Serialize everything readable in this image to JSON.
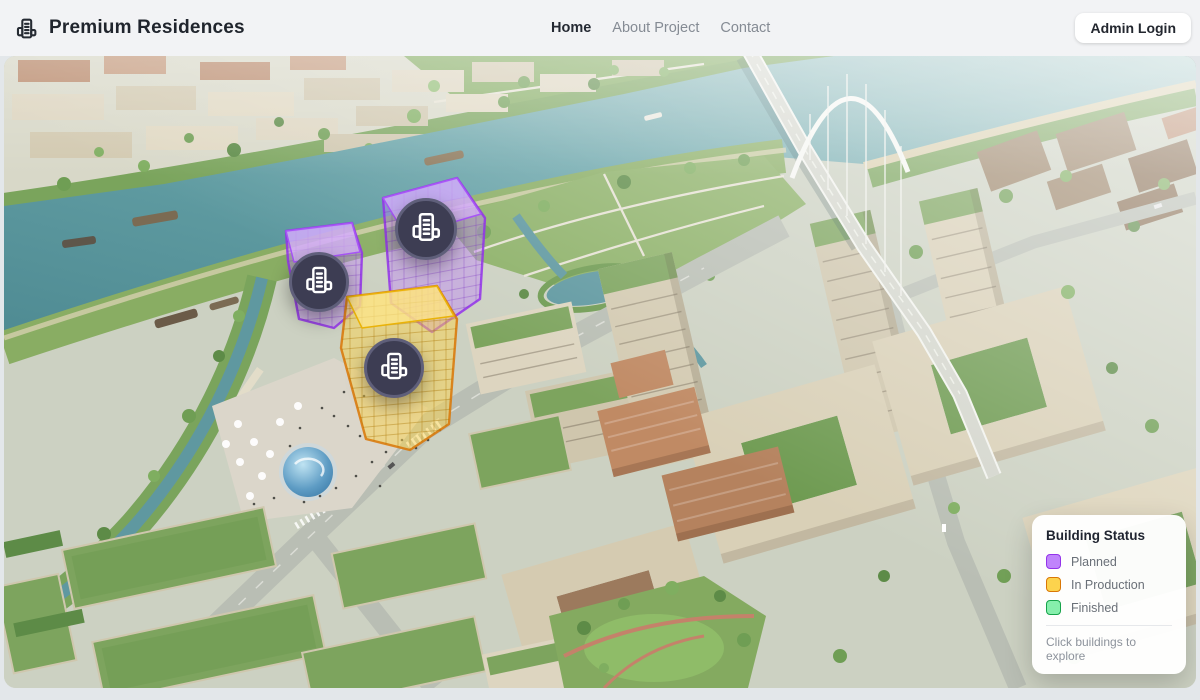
{
  "brand": {
    "name": "Premium Residences",
    "icon": "building-icon"
  },
  "nav": {
    "items": [
      {
        "label": "Home",
        "active": true
      },
      {
        "label": "About Project",
        "active": false
      },
      {
        "label": "Contact",
        "active": false
      }
    ]
  },
  "header": {
    "admin_login_label": "Admin Login"
  },
  "legend": {
    "title": "Building Status",
    "items": [
      {
        "key": "planned",
        "label": "Planned",
        "fill": "#c084fc",
        "border": "#9333ea"
      },
      {
        "key": "inprod",
        "label": "In Production",
        "fill": "#fcd34d",
        "border": "#d97706"
      },
      {
        "key": "finished",
        "label": "Finished",
        "fill": "#86efac",
        "border": "#16a34a"
      }
    ],
    "hint": "Click buildings to explore"
  },
  "map": {
    "buildings": [
      {
        "id": "riverside-cube-small",
        "status": "Planned",
        "marker": {
          "x": 318,
          "y": 229,
          "r": 33
        }
      },
      {
        "id": "riverside-cube-large",
        "status": "Planned",
        "marker": {
          "x": 425,
          "y": 176,
          "r": 34
        }
      },
      {
        "id": "plaza-tower",
        "status": "In Production",
        "marker": {
          "x": 393,
          "y": 315,
          "r": 33
        }
      }
    ],
    "marker_color": "#3d3d53",
    "marker_icon": "building-icon"
  }
}
